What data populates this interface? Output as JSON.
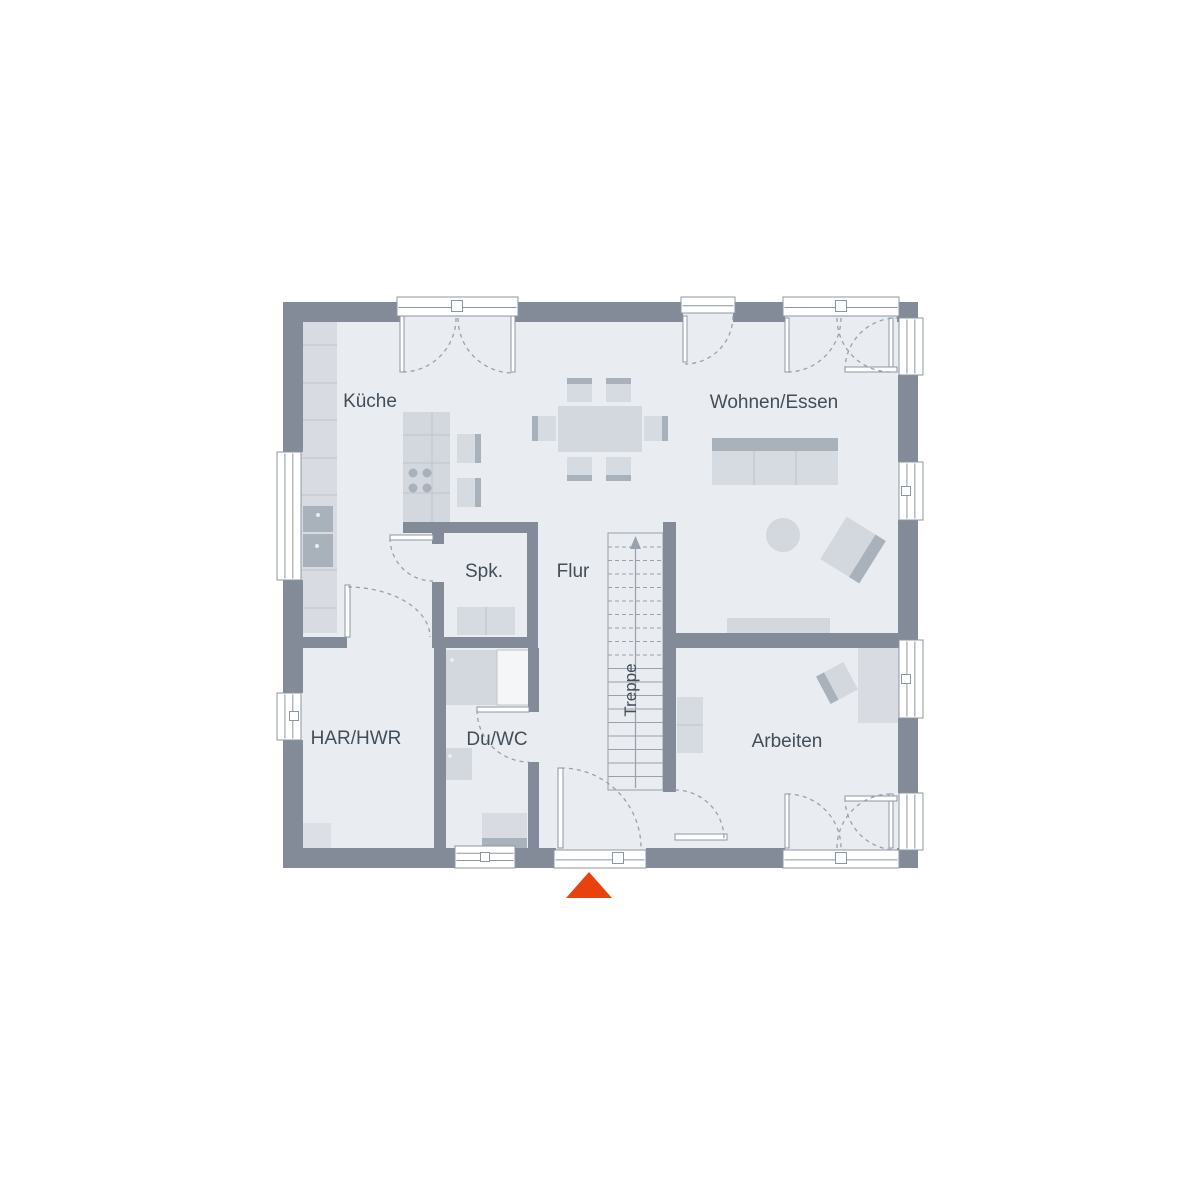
{
  "meta": {
    "type": "floor-plan",
    "floor_shown": "ground-floor"
  },
  "colors": {
    "wall": "#828b97",
    "floor": "#e9ecf0",
    "furn": "#d8dbe1",
    "furnMid": "#d3d7de",
    "furnLight": "#d6dae1",
    "furnDark": "#a9b1bb",
    "lineLight": "#bfc4cc",
    "outline": "#8d97a2",
    "dash": "#98a1ac",
    "label": "#434e59",
    "arrow": "#e8430e",
    "glass": "#f4f6f8",
    "mat": "#dcdfe5"
  },
  "plan": {
    "floor": [
      283,
      302,
      635,
      566
    ],
    "rooms": [
      {
        "id": "kueche",
        "label": "Küche",
        "x": 370,
        "y": 400
      },
      {
        "id": "wohnen-essen",
        "label": "Wohnen/Essen",
        "x": 774,
        "y": 401
      },
      {
        "id": "spk",
        "label": "Spk.",
        "x": 484,
        "y": 570
      },
      {
        "id": "flur",
        "label": "Flur",
        "x": 573,
        "y": 570
      },
      {
        "id": "har-hwr",
        "label": "HAR/HWR",
        "x": 356,
        "y": 737
      },
      {
        "id": "du-wc",
        "label": "Du/WC",
        "x": 497,
        "y": 738
      },
      {
        "id": "arbeiten",
        "label": "Arbeiten",
        "x": 787,
        "y": 740
      },
      {
        "id": "treppe",
        "label": "Treppe",
        "x": 629,
        "y": 690,
        "rot": -90
      }
    ],
    "walls": [
      [
        283,
        302,
        117,
        20
      ],
      [
        515,
        302,
        168,
        20
      ],
      [
        733,
        302,
        52,
        20
      ],
      [
        897,
        302,
        21,
        20
      ],
      [
        283,
        848,
        172,
        20
      ],
      [
        515,
        848,
        41,
        20
      ],
      [
        646,
        848,
        139,
        20
      ],
      [
        897,
        848,
        21,
        20
      ],
      [
        283,
        302,
        20,
        150
      ],
      [
        283,
        580,
        20,
        113
      ],
      [
        283,
        740,
        20,
        128
      ],
      [
        898,
        302,
        20,
        16
      ],
      [
        898,
        375,
        20,
        87
      ],
      [
        898,
        520,
        20,
        120
      ],
      [
        898,
        718,
        20,
        75
      ],
      [
        898,
        850,
        20,
        18
      ],
      [
        403,
        522,
        134,
        11
      ],
      [
        527,
        522,
        11,
        126
      ],
      [
        432,
        530,
        12,
        14
      ],
      [
        432,
        582,
        12,
        66
      ],
      [
        303,
        637,
        44,
        11
      ],
      [
        432,
        637,
        106,
        11
      ],
      [
        434,
        648,
        12,
        200
      ],
      [
        528,
        648,
        11,
        64
      ],
      [
        528,
        762,
        11,
        86
      ],
      [
        663,
        522,
        13,
        270
      ],
      [
        676,
        633,
        242,
        15
      ]
    ],
    "windows": [
      {
        "x": 277,
        "y": 452,
        "w": 24,
        "h": 128,
        "o": "v"
      },
      {
        "x": 277,
        "y": 693,
        "w": 24,
        "h": 47,
        "o": "v",
        "hx": 294,
        "hy": 716
      },
      {
        "x": 899,
        "y": 318,
        "w": 24,
        "h": 57,
        "o": "v"
      },
      {
        "x": 899,
        "y": 462,
        "w": 24,
        "h": 58,
        "o": "v",
        "hx": 906,
        "hy": 491
      },
      {
        "x": 899,
        "y": 640,
        "w": 24,
        "h": 78,
        "o": "v",
        "hx": 906,
        "hy": 679
      },
      {
        "x": 899,
        "y": 793,
        "w": 24,
        "h": 57,
        "o": "v"
      },
      {
        "x": 455,
        "y": 846,
        "w": 60,
        "h": 22,
        "o": "h",
        "hx": 485,
        "hy": 857
      }
    ],
    "door_frames": [
      {
        "x": 397,
        "y": 297,
        "w": 121,
        "h": 19,
        "o": "h",
        "hx": 457,
        "hy": 306
      },
      {
        "x": 681,
        "y": 297,
        "w": 54,
        "h": 16,
        "o": "h"
      },
      {
        "x": 783,
        "y": 297,
        "w": 116,
        "h": 19,
        "o": "h",
        "hx": 841,
        "hy": 306
      },
      {
        "x": 554,
        "y": 850,
        "w": 92,
        "h": 18,
        "o": "h",
        "hx": 618,
        "hy": 858
      },
      {
        "x": 783,
        "y": 850,
        "w": 116,
        "h": 18,
        "o": "h",
        "hx": 841,
        "hy": 858
      }
    ],
    "door_leaves": [
      [
        400,
        316,
        4,
        56
      ],
      [
        511,
        316,
        4,
        56
      ],
      [
        683,
        316,
        4,
        46
      ],
      [
        785,
        318,
        4,
        54
      ],
      [
        889,
        318,
        4,
        54
      ],
      [
        845,
        367,
        52,
        5
      ],
      [
        558,
        768,
        5,
        80
      ],
      [
        785,
        794,
        4,
        54
      ],
      [
        889,
        794,
        4,
        54
      ],
      [
        845,
        796,
        52,
        5
      ],
      [
        477,
        707,
        52,
        5
      ],
      [
        390,
        535,
        43,
        5
      ],
      [
        345,
        585,
        5,
        52
      ],
      [
        675,
        834,
        52,
        6
      ]
    ],
    "swing_arcs": [
      "M456,318 A54,54 0 0 1 402,372",
      "M458,318 A55,55 0 0 0 513,373",
      "M733,316 A48,48 0 0 1 685,364",
      "M841,318 A54,54 0 0 1 787,372",
      "M837,318 A54,54 0 0 0 891,372",
      "M845,370 A52,52 0 0 1 897,318",
      "M561,768 A80,80 0 0 1 641,848",
      "M787,794 A54,54 0 0 1 841,848",
      "M837,848 A54,54 0 0 1 891,794",
      "M845,798 A52,52 0 0 0 897,850",
      "M477,710 A52,52 0 0 0 529,762",
      "M390,538 A43,43 0 0 0 433,581",
      "M348,587 A83,50 0 0 1 430,637",
      "M675,790 A49,49 0 0 1 724,839"
    ],
    "stairs": {
      "x": 608,
      "y": 533,
      "w": 55,
      "h": 257,
      "treadStart": 547,
      "treadStep": 13.5,
      "treadCount": 18,
      "dashedCount": 9,
      "centerX": 635.5
    },
    "furniture": [
      {
        "n": "kitchen-counter",
        "t": "rect",
        "x": 298,
        "y": 308,
        "w": 39,
        "h": 325,
        "f": "@furn"
      },
      {
        "n": "counter-divider",
        "t": "line",
        "p": [
          298,
          345,
          337,
          345
        ]
      },
      {
        "n": "counter-divider",
        "t": "line",
        "p": [
          298,
          383,
          337,
          383
        ]
      },
      {
        "n": "counter-divider",
        "t": "line",
        "p": [
          298,
          420,
          337,
          420
        ]
      },
      {
        "n": "counter-divider",
        "t": "line",
        "p": [
          298,
          458,
          337,
          458
        ]
      },
      {
        "n": "counter-divider",
        "t": "line",
        "p": [
          298,
          495,
          337,
          495
        ]
      },
      {
        "n": "counter-divider",
        "t": "line",
        "p": [
          298,
          570,
          337,
          570
        ]
      },
      {
        "n": "counter-divider",
        "t": "line",
        "p": [
          298,
          608,
          337,
          608
        ]
      },
      {
        "n": "oven",
        "t": "rect",
        "x": 303,
        "y": 506,
        "w": 30,
        "h": 26,
        "f": "@furnDark"
      },
      {
        "n": "appliance-dot",
        "t": "circle",
        "cx": 318,
        "cy": 515,
        "r": 2,
        "f": "@floor"
      },
      {
        "n": "oven",
        "t": "rect",
        "x": 303,
        "y": 534,
        "w": 30,
        "h": 33,
        "f": "@furnDark"
      },
      {
        "n": "appliance-dot",
        "t": "circle",
        "cx": 317,
        "cy": 546,
        "r": 2,
        "f": "@floor"
      },
      {
        "n": "kitchen-island",
        "t": "rect",
        "x": 403,
        "y": 412,
        "w": 47,
        "h": 110,
        "f": "@furnMid"
      },
      {
        "n": "island-divider",
        "t": "line",
        "p": [
          432,
          412,
          432,
          522
        ]
      },
      {
        "n": "island-divider",
        "t": "line",
        "p": [
          403,
          435,
          450,
          435
        ]
      },
      {
        "n": "island-divider",
        "t": "line",
        "p": [
          403,
          463,
          450,
          463
        ]
      },
      {
        "n": "island-divider",
        "t": "line",
        "p": [
          403,
          493,
          450,
          493
        ]
      },
      {
        "n": "burner",
        "t": "circle",
        "cx": 413,
        "cy": 473,
        "r": 4.5,
        "f": "@furnDark"
      },
      {
        "n": "burner",
        "t": "circle",
        "cx": 427,
        "cy": 473,
        "r": 4.5,
        "f": "@furnDark"
      },
      {
        "n": "burner",
        "t": "circle",
        "cx": 413,
        "cy": 488,
        "r": 4.5,
        "f": "@furnDark"
      },
      {
        "n": "burner",
        "t": "circle",
        "cx": 427,
        "cy": 488,
        "r": 4.5,
        "f": "@furnDark"
      },
      {
        "n": "stool",
        "t": "rect",
        "x": 457,
        "y": 434,
        "w": 24,
        "h": 29,
        "f": "@furnLight"
      },
      {
        "n": "stool-back",
        "t": "rect",
        "x": 475,
        "y": 434,
        "w": 6,
        "h": 29,
        "f": "@furnDark"
      },
      {
        "n": "stool",
        "t": "rect",
        "x": 457,
        "y": 478,
        "w": 24,
        "h": 29,
        "f": "@furnLight"
      },
      {
        "n": "stool-back",
        "t": "rect",
        "x": 475,
        "y": 478,
        "w": 6,
        "h": 29,
        "f": "@furnDark"
      },
      {
        "n": "dining-table",
        "t": "rect",
        "x": 558,
        "y": 406,
        "w": 84,
        "h": 46,
        "f": "@furnMid"
      },
      {
        "n": "chair",
        "t": "rect",
        "x": 567,
        "y": 378,
        "w": 25,
        "h": 24,
        "f": "@furnLight"
      },
      {
        "n": "chair-back",
        "t": "rect",
        "x": 567,
        "y": 378,
        "w": 25,
        "h": 6,
        "f": "@furnDark"
      },
      {
        "n": "chair",
        "t": "rect",
        "x": 606,
        "y": 378,
        "w": 25,
        "h": 24,
        "f": "@furnLight"
      },
      {
        "n": "chair-back",
        "t": "rect",
        "x": 606,
        "y": 378,
        "w": 25,
        "h": 6,
        "f": "@furnDark"
      },
      {
        "n": "chair",
        "t": "rect",
        "x": 567,
        "y": 457,
        "w": 25,
        "h": 24,
        "f": "@furnLight"
      },
      {
        "n": "chair-back",
        "t": "rect",
        "x": 567,
        "y": 475,
        "w": 25,
        "h": 6,
        "f": "@furnDark"
      },
      {
        "n": "chair",
        "t": "rect",
        "x": 606,
        "y": 457,
        "w": 25,
        "h": 24,
        "f": "@furnLight"
      },
      {
        "n": "chair-back",
        "t": "rect",
        "x": 606,
        "y": 475,
        "w": 25,
        "h": 6,
        "f": "@furnDark"
      },
      {
        "n": "chair",
        "t": "rect",
        "x": 532,
        "y": 416,
        "w": 24,
        "h": 25,
        "f": "@furnLight"
      },
      {
        "n": "chair-back",
        "t": "rect",
        "x": 532,
        "y": 416,
        "w": 6,
        "h": 25,
        "f": "@furnDark"
      },
      {
        "n": "chair",
        "t": "rect",
        "x": 644,
        "y": 416,
        "w": 24,
        "h": 25,
        "f": "@furnLight"
      },
      {
        "n": "chair-back",
        "t": "rect",
        "x": 662,
        "y": 416,
        "w": 6,
        "h": 25,
        "f": "@furnDark"
      },
      {
        "n": "sofa-back",
        "t": "rect",
        "x": 712,
        "y": 438,
        "w": 126,
        "h": 13,
        "f": "@furnDark"
      },
      {
        "n": "sofa",
        "t": "rect",
        "x": 712,
        "y": 451,
        "w": 126,
        "h": 34,
        "f": "@furnLight"
      },
      {
        "n": "sofa-divider",
        "t": "line",
        "p": [
          754,
          451,
          754,
          485
        ]
      },
      {
        "n": "sofa-divider",
        "t": "line",
        "p": [
          796,
          451,
          796,
          485
        ]
      },
      {
        "n": "coffee-table",
        "t": "circle",
        "cx": 783,
        "cy": 535,
        "r": 17,
        "f": "@furnMid"
      },
      {
        "n": "armchair",
        "t": "rot",
        "cx": 853,
        "cy": 550,
        "w": 46,
        "h": 50,
        "rot": 32,
        "f": "@furnMid",
        "sw": 12,
        "side": "right",
        "sf": "@furnDark"
      },
      {
        "n": "sideboard",
        "t": "rect",
        "x": 727,
        "y": 618,
        "w": 103,
        "h": 15,
        "f": "@furnMid"
      },
      {
        "n": "couch",
        "t": "rect",
        "x": 677,
        "y": 697,
        "w": 26,
        "h": 56,
        "f": "@furnLight"
      },
      {
        "n": "couch-divider",
        "t": "line",
        "p": [
          677,
          725,
          703,
          725
        ]
      },
      {
        "n": "desk",
        "t": "rect",
        "x": 858,
        "y": 647,
        "w": 42,
        "h": 76,
        "f": "@furn"
      },
      {
        "n": "desk-chair",
        "t": "rot",
        "cx": 837,
        "cy": 683,
        "w": 31,
        "h": 31,
        "rot": -28,
        "f": "@furnMid",
        "sw": 9,
        "side": "left",
        "sf": "@furnDark"
      },
      {
        "n": "pantry-cupboard",
        "t": "rect",
        "x": 457,
        "y": 607,
        "w": 58,
        "h": 28,
        "f": "@furnLight"
      },
      {
        "n": "cupboard-divider",
        "t": "line",
        "p": [
          486,
          607,
          486,
          635
        ]
      },
      {
        "n": "shower",
        "t": "rect",
        "x": 442,
        "y": 650,
        "w": 55,
        "h": 55,
        "f": "@furnMid"
      },
      {
        "n": "shower-glass",
        "t": "rect",
        "x": 497,
        "y": 650,
        "w": 32,
        "h": 55,
        "f": "@glass",
        "s": "@lineLight"
      },
      {
        "n": "fixture-dot",
        "t": "circle",
        "cx": 452,
        "cy": 660,
        "r": 2,
        "f": "@floor"
      },
      {
        "n": "toilet",
        "t": "rect",
        "x": 442,
        "y": 748,
        "w": 30,
        "h": 32,
        "f": "@furnMid"
      },
      {
        "n": "fixture-dot",
        "t": "circle",
        "cx": 450,
        "cy": 756,
        "r": 2,
        "f": "@floor"
      },
      {
        "n": "washbasin",
        "t": "rect",
        "x": 482,
        "y": 813,
        "w": 45,
        "h": 25,
        "f": "@furn"
      },
      {
        "n": "washbasin-base",
        "t": "rect",
        "x": 482,
        "y": 838,
        "w": 45,
        "h": 10,
        "f": "@furnDark"
      },
      {
        "n": "floor-mat",
        "t": "rect",
        "x": 299,
        "y": 823,
        "w": 32,
        "h": 30,
        "f": "@mat"
      }
    ],
    "entrance_arrow": {
      "points": "589,872 566,898 612,898",
      "color": "@arrow"
    }
  }
}
